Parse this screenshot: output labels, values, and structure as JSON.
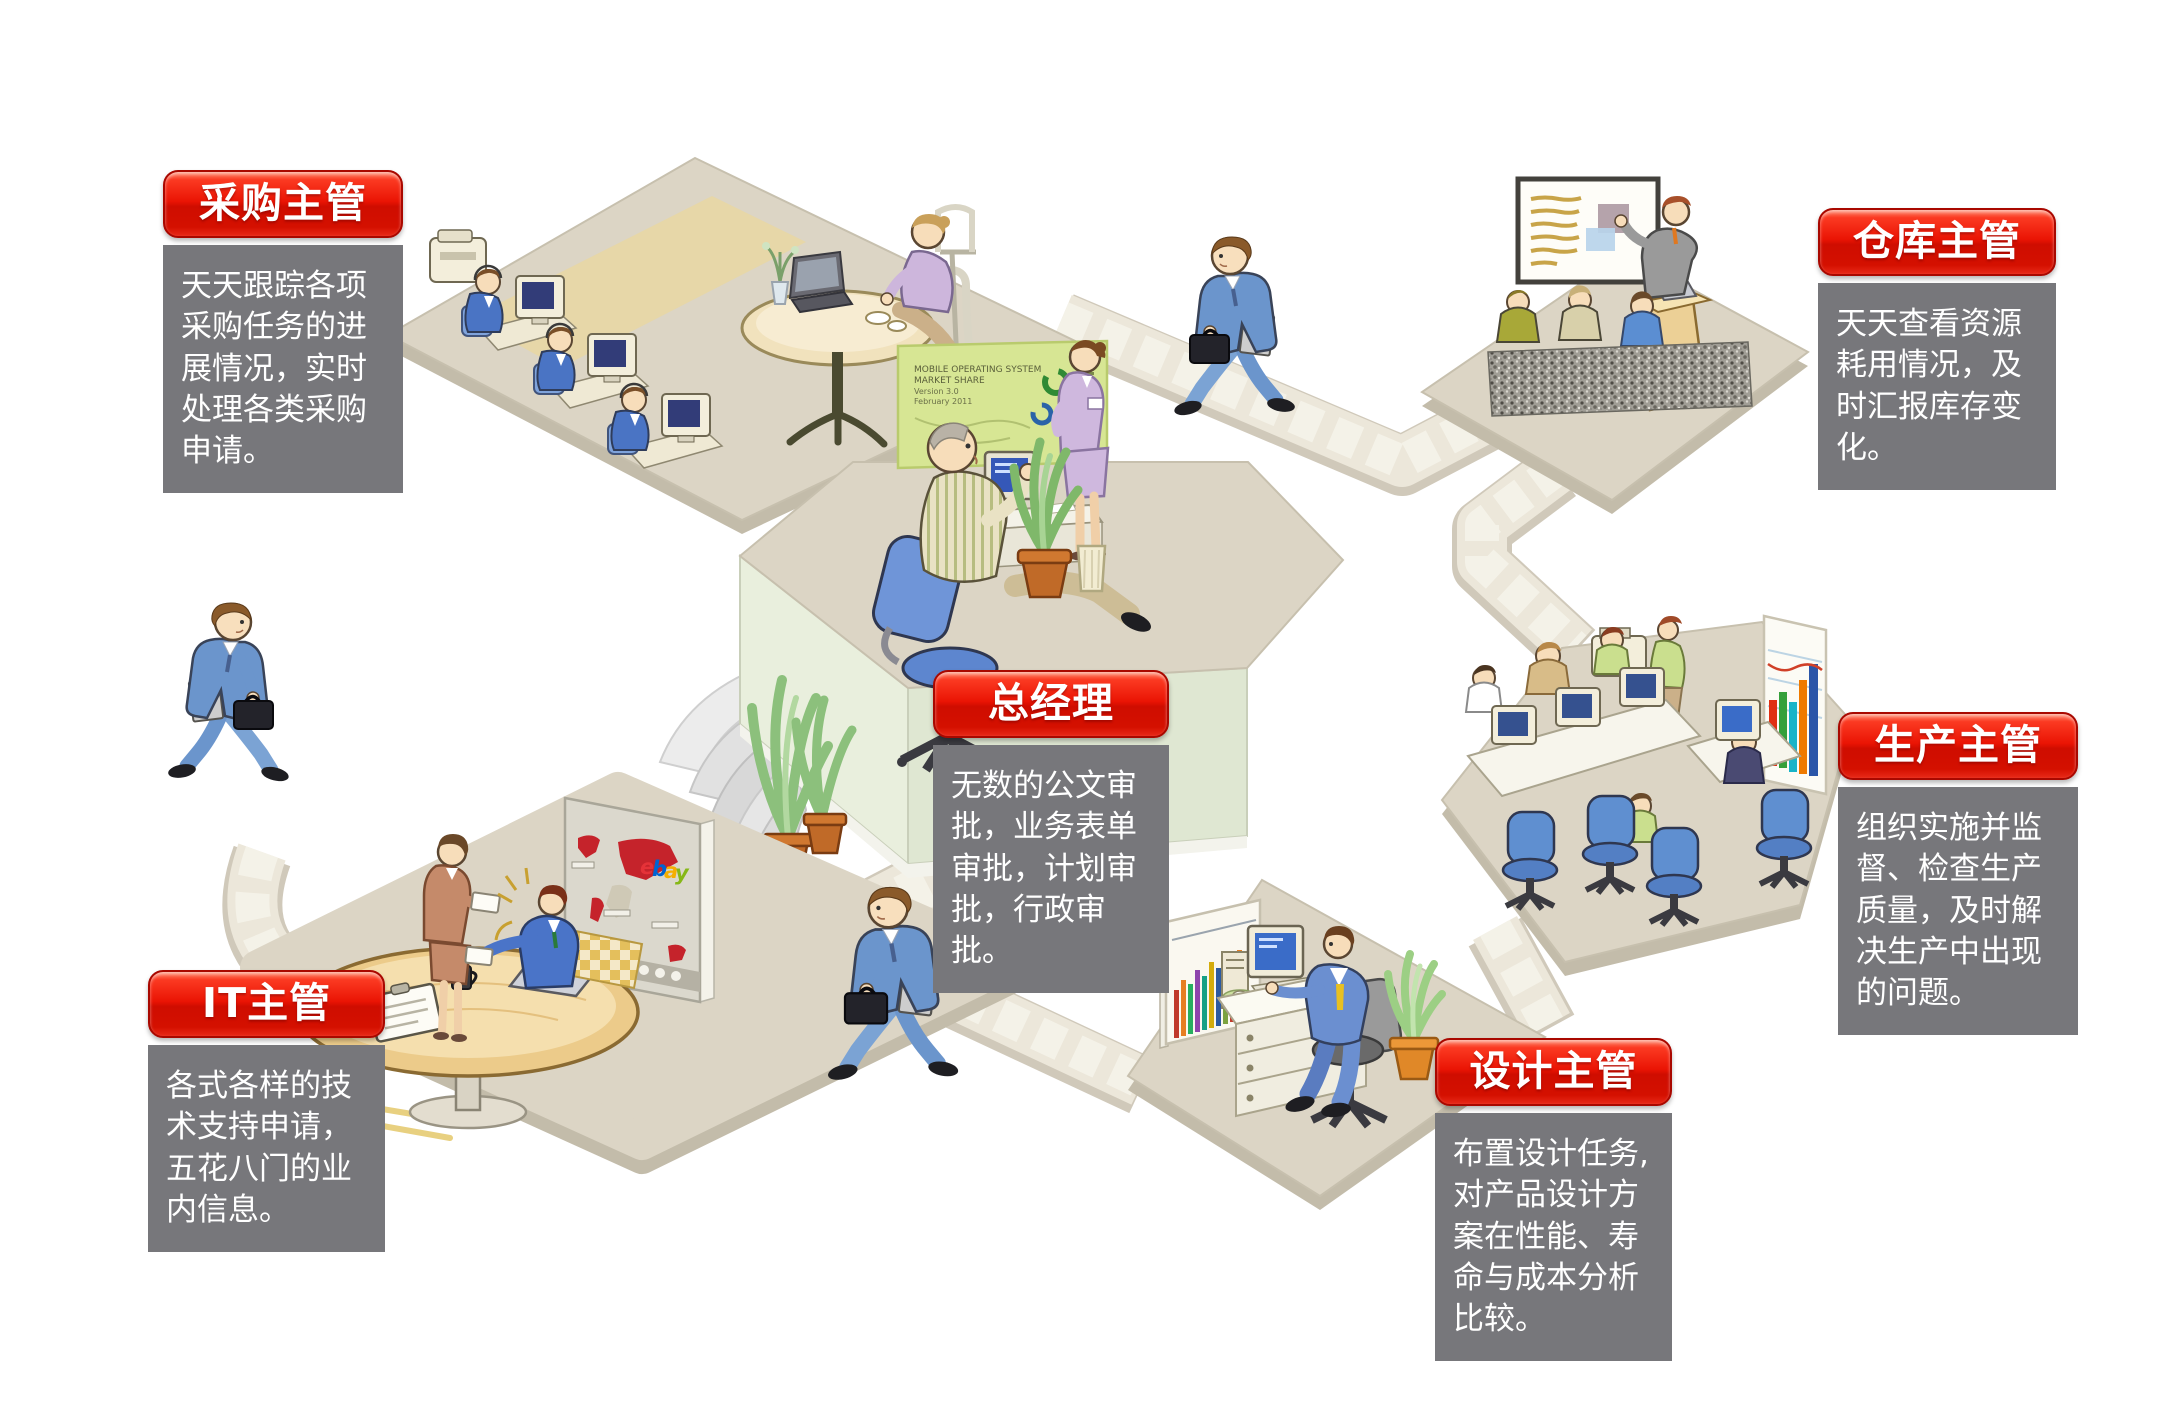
{
  "page": {
    "background": "#ffffff",
    "type": "enterprise-workflow-infographic"
  },
  "roles": [
    {
      "key": "purchasing",
      "label": "采购主管",
      "description": "天天跟踪各项\n采购任务的进\n展情况，实时\n处理各类采购\n申请。"
    },
    {
      "key": "warehouse",
      "label": "仓库主管",
      "description": "天天查看资源\n耗用情况，及\n时汇报库存变\n化。"
    },
    {
      "key": "general-manager",
      "label": "总经理",
      "description": "无数的公文审\n批，业务表单\n审批，计划审\n批，行政审批。"
    },
    {
      "key": "production",
      "label": "生产主管",
      "description": "组织实施并监\n督、检查生产\n质量，及时解\n决生产中出现\n的问题。"
    },
    {
      "key": "it",
      "label": "IT主管",
      "description": "各式各样的技\n术支持申请，\n五花八门的业\n内信息。"
    },
    {
      "key": "design",
      "label": "设计主管",
      "description": "布置设计任务,\n对产品设计方\n案在性能、寿\n命与成本分析\n比较。"
    }
  ],
  "illustration": {
    "gm_board_lines": [
      "MOBILE OPERATING SYSTEM",
      "MARKET SHARE",
      "Version 3.0",
      "February 2011"
    ],
    "map_logo_chars": [
      "e",
      "b",
      "a",
      "y"
    ],
    "colors": {
      "accent_red": "#e01000",
      "panel_gray": "#77777b",
      "platform_top": "#dcd5c5",
      "platform_side_green": "#e9efdd",
      "stone_path": "#ece7da",
      "gm_board_green": "#d7e694",
      "map_red": "#c5232b",
      "production_chart": [
        "#e03012",
        "#35a03a",
        "#18b4c8",
        "#ef7a00",
        "#2a55a8"
      ]
    }
  }
}
